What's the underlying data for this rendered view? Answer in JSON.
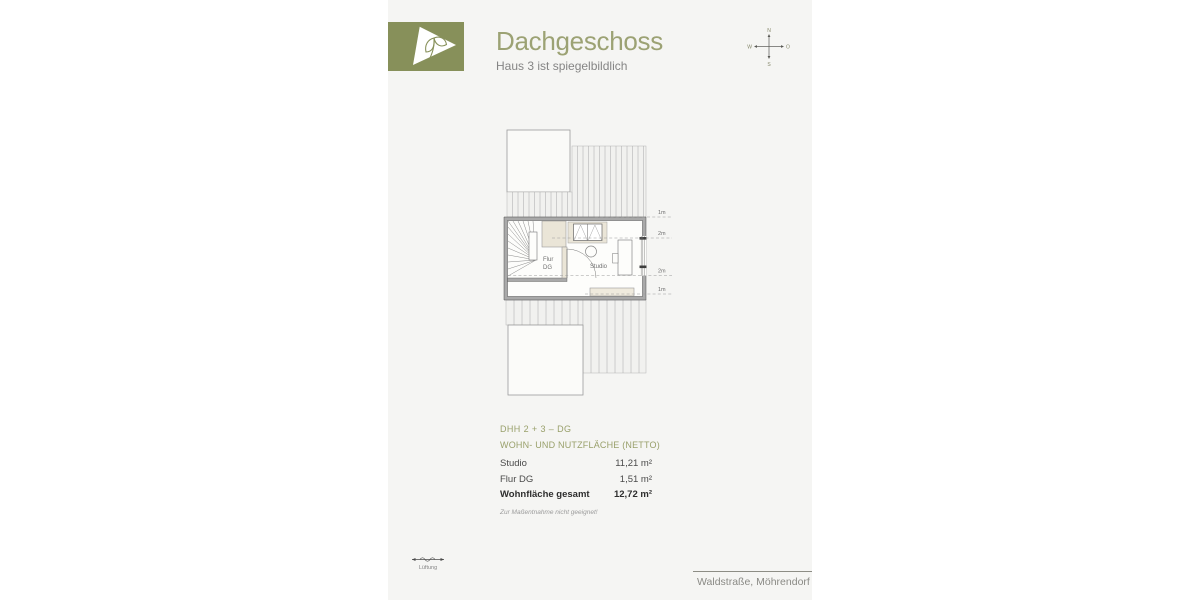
{
  "colors": {
    "accent_olive": "#87905a",
    "title_olive": "#9ca274",
    "table_header_olive": "#99a06b",
    "page_background": "#f5f5f3"
  },
  "header": {
    "title": "Dachgeschoss",
    "subtitle": "Haus 3 ist spiegelbildlich"
  },
  "compass": {
    "north": "N",
    "east": "O",
    "south": "S",
    "west": "W"
  },
  "plan": {
    "room_flur": [
      "Flur",
      "DG"
    ],
    "room_studio": "Studio",
    "dims": [
      "1m",
      "2m",
      "2m",
      "1m"
    ]
  },
  "area_table": {
    "title": "DHH 2 + 3 – DG",
    "subtitle": "WOHN- UND NUTZFLÄCHE (NETTO)",
    "rows": [
      {
        "label": "Studio",
        "value": "11,21 m²"
      },
      {
        "label": "Flur DG",
        "value": "1,51 m²"
      }
    ],
    "total": {
      "label": "Wohnfläche gesamt",
      "value": "12,72 m²"
    },
    "note": "Zur Maßentnahme nicht geeignet!"
  },
  "legend": {
    "ventilation": "Lüftung"
  },
  "footer": {
    "address": "Waldstraße, Möhrendorf"
  }
}
